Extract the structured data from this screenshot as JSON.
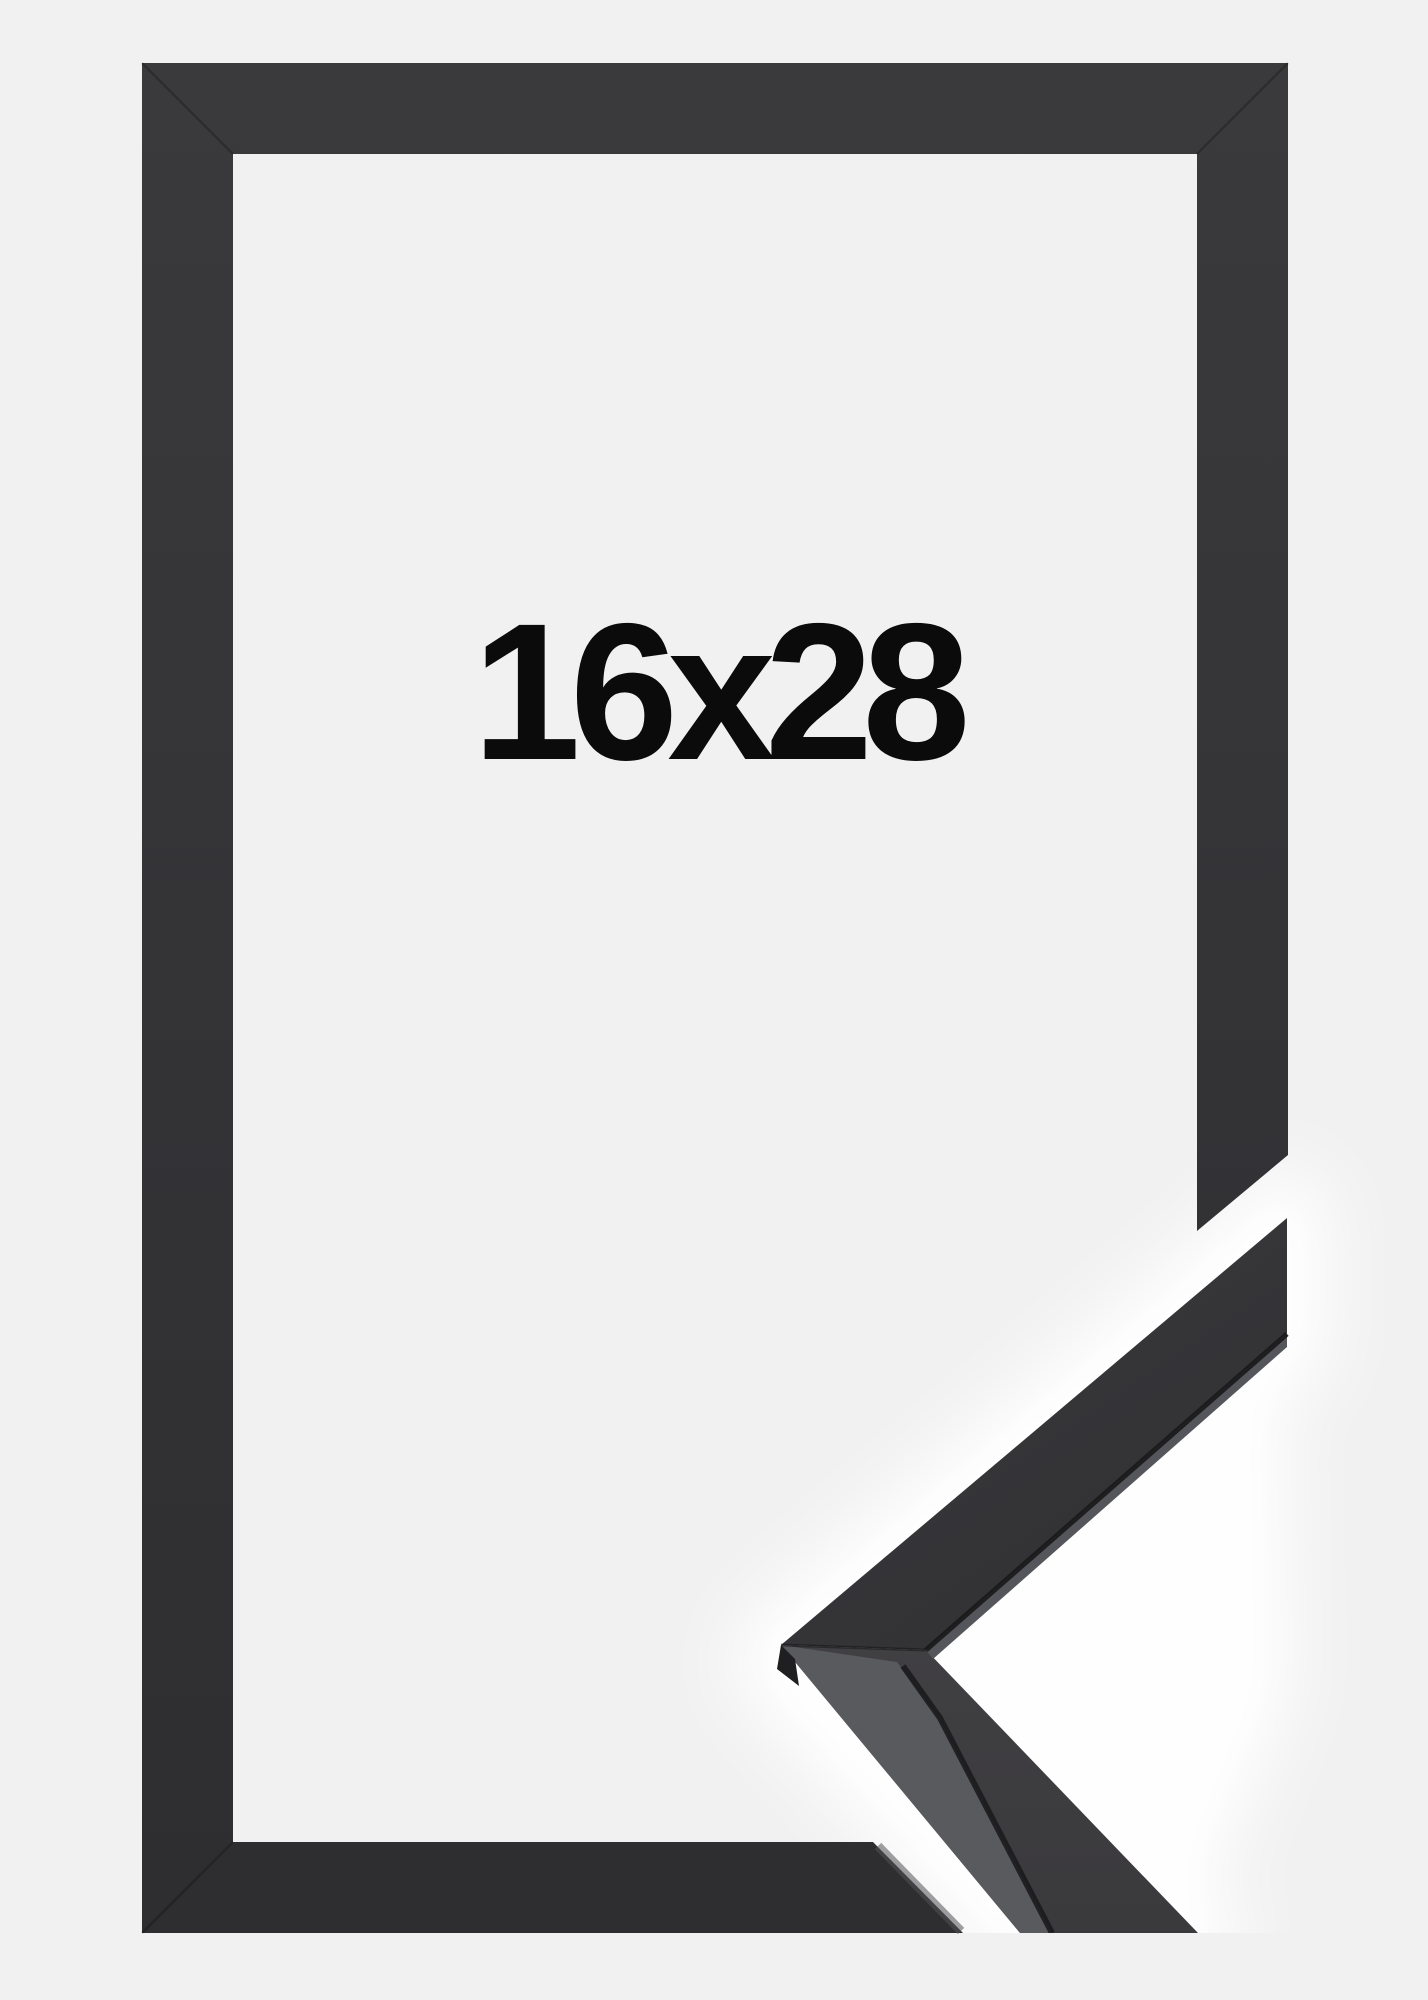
{
  "page": {
    "background_color": "#f1f1f1"
  },
  "frame": {
    "color_name": "black",
    "face_color": "#343437",
    "face_color_top": "#3a3a3c",
    "face_color_bottom": "#2e2e30",
    "side_highlight_color": "#55565b",
    "crease_color": "#1b1b1d",
    "gap_glow_color": "#ffffff"
  },
  "size_label": {
    "text": "16x28",
    "color": "#0b0b0b"
  }
}
